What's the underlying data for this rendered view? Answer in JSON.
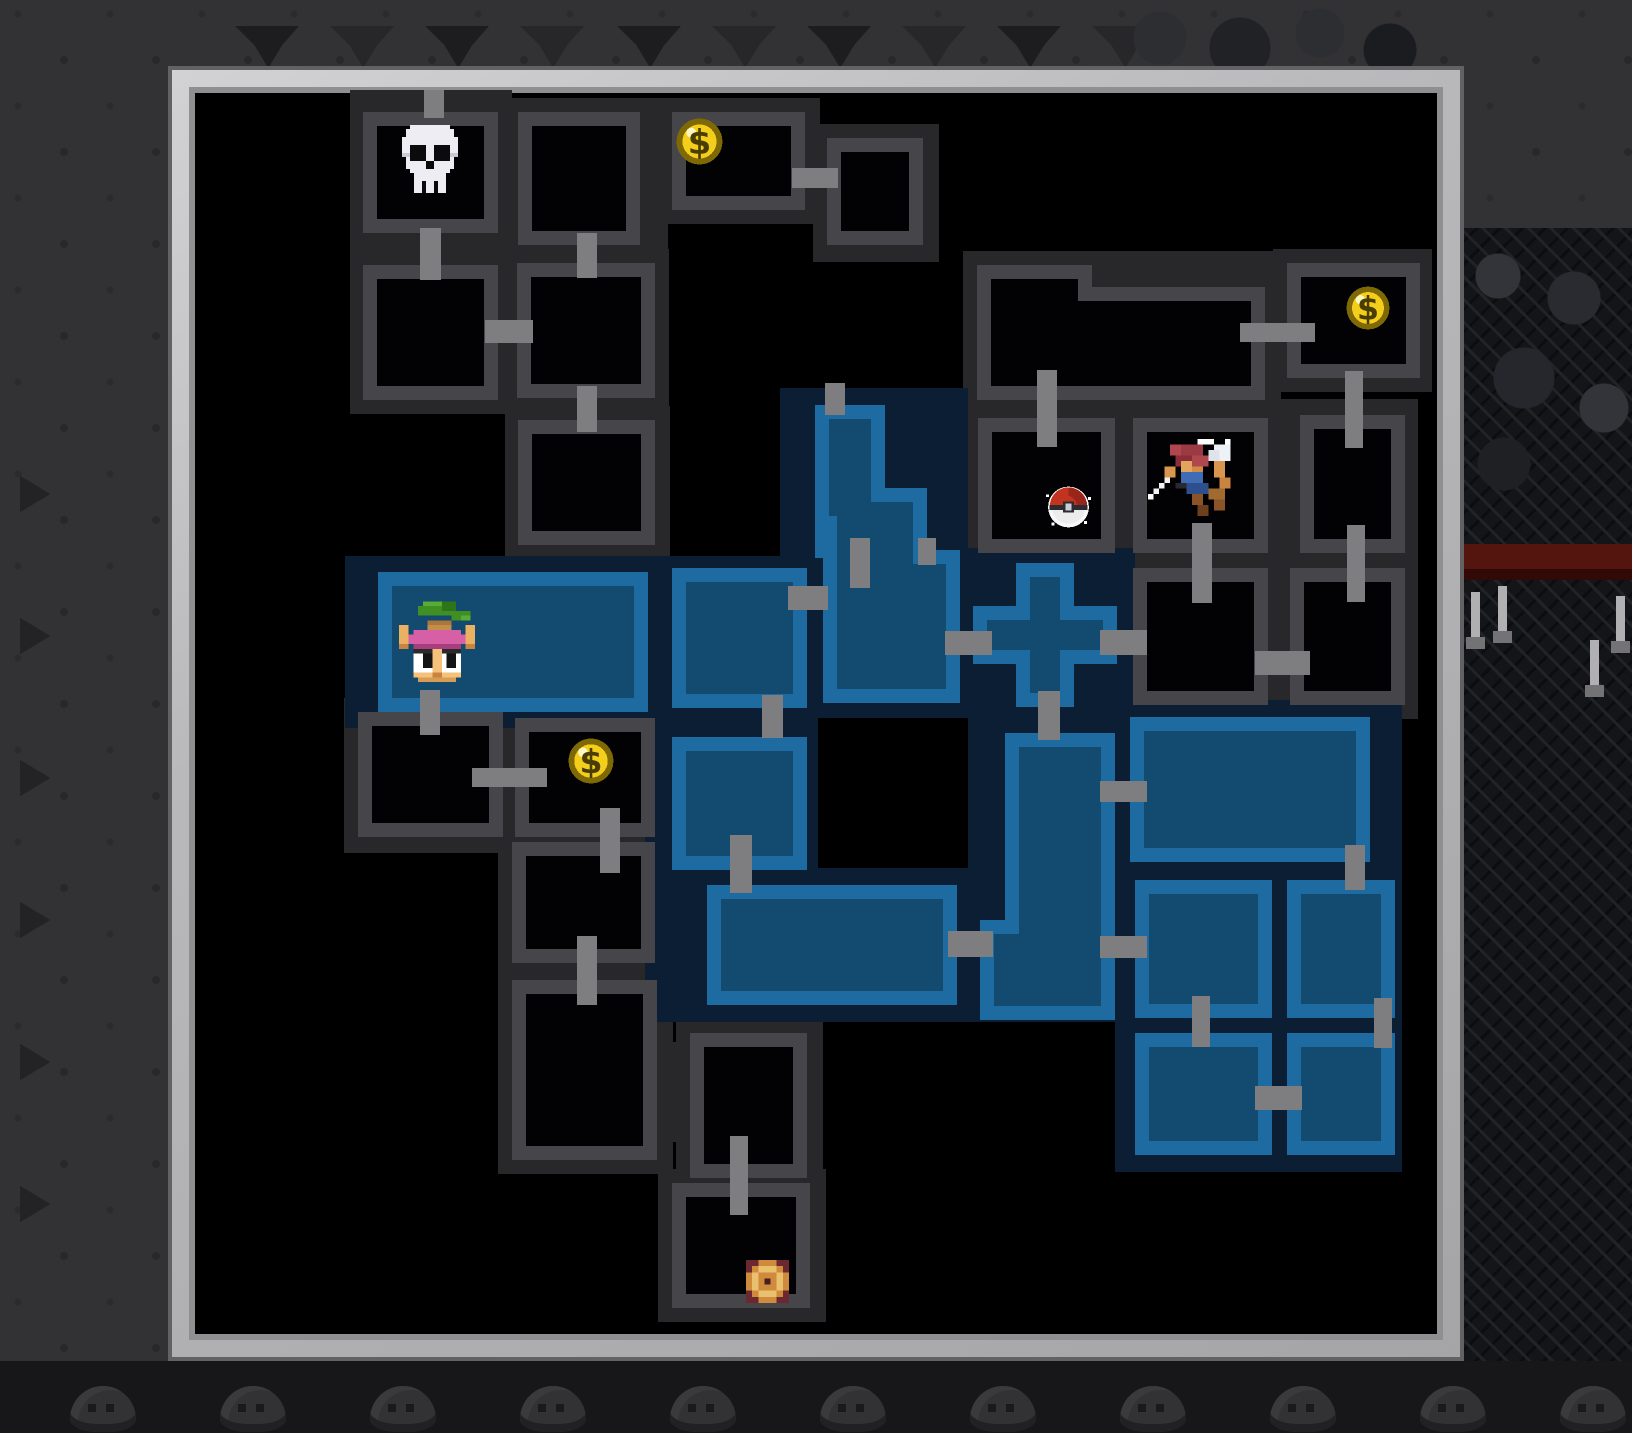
{
  "app": {
    "view": "dungeon-minimap-overlay"
  },
  "colors": {
    "cave_background": "#323234",
    "frame_silver": "#b9b9bb",
    "map_black": "#000000",
    "unexplored_fog": "#28282b",
    "explored_navy": "#0c1e33",
    "room_gray_border": "#45454a",
    "room_blue_border": "#1e6ba1",
    "room_blue_fill": "#124a70",
    "corridor_gray": "#7e7e80",
    "coin_gold": "#f3cf1b",
    "lava_red": "#55150f"
  },
  "map": {
    "frame": {
      "x": 168,
      "y": 66,
      "w": 1296,
      "h": 1295
    },
    "fog": [
      [
        350,
        90,
        162,
        324
      ],
      [
        505,
        98,
        163,
        164
      ],
      [
        658,
        98,
        162,
        126
      ],
      [
        813,
        124,
        126,
        138
      ],
      [
        503,
        249,
        166,
        165
      ],
      [
        505,
        406,
        165,
        152
      ],
      [
        963,
        251,
        318,
        165
      ],
      [
        1273,
        249,
        159,
        143
      ],
      [
        963,
        404,
        169,
        160
      ],
      [
        1119,
        404,
        165,
        162
      ],
      [
        1119,
        554,
        165,
        165
      ],
      [
        1278,
        399,
        140,
        320
      ],
      [
        344,
        698,
        175,
        155
      ],
      [
        501,
        704,
        170,
        150
      ],
      [
        498,
        828,
        173,
        150
      ],
      [
        498,
        966,
        175,
        208
      ],
      [
        676,
        1019,
        147,
        173
      ],
      [
        640,
        1042,
        64,
        100
      ],
      [
        658,
        1169,
        168,
        153
      ]
    ],
    "navy": [
      [
        345,
        556,
        627,
        172
      ],
      [
        780,
        388,
        188,
        170
      ],
      [
        645,
        726,
        327,
        296
      ],
      [
        956,
        548,
        179,
        182
      ],
      [
        956,
        728,
        176,
        294
      ],
      [
        1115,
        700,
        287,
        472
      ]
    ],
    "holes": [
      [
        818,
        718,
        150,
        150
      ]
    ],
    "rooms_gray": [
      {
        "shape": [
          [
            363,
            112,
            135,
            121
          ]
        ],
        "fill": [
          [
            377,
            126,
            107,
            93
          ]
        ]
      },
      {
        "shape": [
          [
            363,
            265,
            135,
            135
          ]
        ],
        "fill": [
          [
            377,
            279,
            107,
            107
          ]
        ]
      },
      {
        "shape": [
          [
            518,
            112,
            122,
            133
          ]
        ],
        "fill": [
          [
            532,
            126,
            94,
            105
          ]
        ]
      },
      {
        "shape": [
          [
            672,
            112,
            133,
            98
          ]
        ],
        "fill": [
          [
            686,
            126,
            105,
            70
          ]
        ]
      },
      {
        "shape": [
          [
            827,
            138,
            96,
            107
          ]
        ],
        "fill": [
          [
            841,
            152,
            68,
            79
          ]
        ]
      },
      {
        "shape": [
          [
            517,
            263,
            138,
            135
          ]
        ],
        "fill": [
          [
            531,
            277,
            110,
            107
          ]
        ]
      },
      {
        "shape": [
          [
            518,
            420,
            137,
            125
          ]
        ],
        "fill": [
          [
            532,
            434,
            109,
            97
          ]
        ]
      },
      {
        "shape": [
          [
            977,
            265,
            115,
            135
          ],
          [
            977,
            287,
            288,
            113
          ]
        ],
        "fill": [
          [
            991,
            279,
            87,
            107
          ],
          [
            991,
            301,
            260,
            85
          ]
        ]
      },
      {
        "shape": [
          [
            1287,
            263,
            133,
            115
          ]
        ],
        "fill": [
          [
            1301,
            277,
            105,
            87
          ]
        ]
      },
      {
        "shape": [
          [
            978,
            418,
            137,
            135
          ]
        ],
        "fill": [
          [
            992,
            432,
            109,
            107
          ]
        ]
      },
      {
        "shape": [
          [
            1133,
            418,
            135,
            135
          ]
        ],
        "fill": [
          [
            1147,
            432,
            107,
            107
          ]
        ]
      },
      {
        "shape": [
          [
            1133,
            568,
            135,
            137
          ]
        ],
        "fill": [
          [
            1147,
            582,
            107,
            109
          ]
        ]
      },
      {
        "shape": [
          [
            1300,
            415,
            105,
            138
          ]
        ],
        "fill": [
          [
            1314,
            429,
            77,
            110
          ]
        ]
      },
      {
        "shape": [
          [
            1290,
            568,
            115,
            137
          ]
        ],
        "fill": [
          [
            1304,
            582,
            87,
            109
          ]
        ]
      },
      {
        "shape": [
          [
            358,
            712,
            145,
            125
          ]
        ],
        "fill": [
          [
            372,
            726,
            117,
            97
          ]
        ]
      },
      {
        "shape": [
          [
            515,
            718,
            140,
            119
          ]
        ],
        "fill": [
          [
            529,
            732,
            112,
            91
          ]
        ]
      },
      {
        "shape": [
          [
            512,
            842,
            143,
            121
          ]
        ],
        "fill": [
          [
            526,
            856,
            115,
            93
          ]
        ]
      },
      {
        "shape": [
          [
            512,
            980,
            145,
            180
          ]
        ],
        "fill": [
          [
            526,
            994,
            117,
            152
          ]
        ]
      },
      {
        "shape": [
          [
            690,
            1033,
            117,
            145
          ]
        ],
        "fill": [
          [
            704,
            1047,
            89,
            117
          ]
        ]
      },
      {
        "shape": [
          [
            672,
            1183,
            138,
            125
          ]
        ],
        "fill": [
          [
            686,
            1197,
            110,
            97
          ]
        ]
      }
    ],
    "rooms_blue": [
      {
        "shape": [
          [
            815,
            405,
            70,
            90
          ],
          [
            815,
            488,
            112,
            70
          ],
          [
            823,
            550,
            137,
            153
          ]
        ],
        "fill": [
          [
            829,
            419,
            42,
            97
          ],
          [
            837,
            502,
            76,
            70
          ],
          [
            837,
            564,
            109,
            125
          ]
        ]
      },
      {
        "shape": [
          [
            378,
            572,
            270,
            140
          ]
        ],
        "fill": [
          [
            392,
            586,
            242,
            112
          ]
        ]
      },
      {
        "shape": [
          [
            672,
            568,
            135,
            140
          ]
        ],
        "fill": [
          [
            686,
            582,
            107,
            112
          ]
        ]
      },
      {
        "shape": [
          [
            1016,
            563,
            58,
            144
          ],
          [
            973,
            606,
            144,
            58
          ]
        ],
        "fill": [
          [
            1030,
            577,
            30,
            116
          ],
          [
            987,
            620,
            116,
            30
          ]
        ]
      },
      {
        "shape": [
          [
            672,
            737,
            135,
            133
          ]
        ],
        "fill": [
          [
            686,
            751,
            107,
            105
          ]
        ]
      },
      {
        "shape": [
          [
            707,
            885,
            250,
            120
          ]
        ],
        "fill": [
          [
            721,
            899,
            222,
            92
          ]
        ]
      },
      {
        "shape": [
          [
            1005,
            733,
            110,
            200
          ],
          [
            980,
            920,
            135,
            100
          ]
        ],
        "fill": [
          [
            1019,
            747,
            82,
            200
          ],
          [
            994,
            934,
            107,
            72
          ]
        ]
      },
      {
        "shape": [
          [
            1130,
            717,
            240,
            145
          ]
        ],
        "fill": [
          [
            1144,
            731,
            212,
            117
          ]
        ]
      },
      {
        "shape": [
          [
            1135,
            880,
            137,
            138
          ]
        ],
        "fill": [
          [
            1149,
            894,
            109,
            110
          ]
        ]
      },
      {
        "shape": [
          [
            1287,
            880,
            108,
            138
          ]
        ],
        "fill": [
          [
            1301,
            894,
            80,
            110
          ]
        ]
      },
      {
        "shape": [
          [
            1135,
            1033,
            137,
            122
          ]
        ],
        "fill": [
          [
            1149,
            1047,
            109,
            94
          ]
        ]
      },
      {
        "shape": [
          [
            1287,
            1033,
            108,
            122
          ]
        ],
        "fill": [
          [
            1301,
            1047,
            80,
            94
          ]
        ]
      }
    ],
    "connectors": [
      [
        424,
        90,
        20,
        28
      ],
      [
        420,
        228,
        21,
        52
      ],
      [
        485,
        320,
        48,
        23
      ],
      [
        577,
        233,
        20,
        45
      ],
      [
        577,
        386,
        20,
        46
      ],
      [
        792,
        168,
        46,
        20
      ],
      [
        1240,
        323,
        75,
        19
      ],
      [
        1037,
        370,
        20,
        77
      ],
      [
        1345,
        371,
        18,
        77
      ],
      [
        1192,
        523,
        20,
        80
      ],
      [
        1347,
        525,
        18,
        77
      ],
      [
        1255,
        651,
        55,
        24
      ],
      [
        1100,
        630,
        47,
        25
      ],
      [
        945,
        631,
        47,
        24
      ],
      [
        825,
        383,
        20,
        32
      ],
      [
        850,
        538,
        20,
        50
      ],
      [
        918,
        538,
        18,
        27
      ],
      [
        788,
        586,
        40,
        24
      ],
      [
        762,
        695,
        21,
        43
      ],
      [
        730,
        835,
        22,
        58
      ],
      [
        948,
        931,
        45,
        26
      ],
      [
        1038,
        691,
        22,
        49
      ],
      [
        1100,
        781,
        47,
        21
      ],
      [
        1100,
        936,
        47,
        22
      ],
      [
        1345,
        845,
        20,
        45
      ],
      [
        1192,
        996,
        18,
        51
      ],
      [
        1255,
        1086,
        47,
        24
      ],
      [
        1374,
        998,
        18,
        50
      ],
      [
        420,
        690,
        20,
        45
      ],
      [
        472,
        768,
        75,
        19
      ],
      [
        600,
        808,
        20,
        65
      ],
      [
        577,
        936,
        20,
        69
      ],
      [
        730,
        1136,
        18,
        79
      ]
    ],
    "icons": [
      {
        "name": "skull-icon",
        "type": "skull",
        "x": 398,
        "y": 124,
        "w": 64,
        "h": 70
      },
      {
        "name": "coin-icon",
        "type": "coin",
        "x": 676,
        "y": 118,
        "w": 47,
        "h": 47
      },
      {
        "name": "coin-icon",
        "type": "coin",
        "x": 1346,
        "y": 286,
        "w": 44,
        "h": 44
      },
      {
        "name": "coin-icon",
        "type": "coin",
        "x": 568,
        "y": 738,
        "w": 46,
        "h": 46
      },
      {
        "name": "pokeball-icon",
        "type": "pokeball",
        "x": 1046,
        "y": 483,
        "w": 45,
        "h": 48
      },
      {
        "name": "player-icon",
        "type": "trainer",
        "x": 1148,
        "y": 438,
        "w": 88,
        "h": 90
      },
      {
        "name": "mushroom-npc-icon",
        "type": "mushroom",
        "x": 399,
        "y": 597,
        "w": 76,
        "h": 94
      },
      {
        "name": "stairs-icon",
        "type": "stairs",
        "x": 746,
        "y": 1260,
        "w": 43,
        "h": 43
      }
    ]
  },
  "background": {
    "teeth_x": [
      235,
      330,
      425,
      520,
      617,
      712,
      807,
      902,
      997,
      1092
    ],
    "chevrons_y": [
      470,
      612,
      754,
      896,
      1038,
      1180
    ],
    "candles": [
      [
        1471,
        592
      ],
      [
        1498,
        586
      ],
      [
        1616,
        596
      ],
      [
        1590,
        640
      ]
    ],
    "bumps_x": [
      70,
      220,
      370,
      520,
      670,
      820,
      970,
      1120,
      1270,
      1420,
      1560
    ],
    "red_band": [
      1464,
      544,
      168,
      36
    ]
  }
}
